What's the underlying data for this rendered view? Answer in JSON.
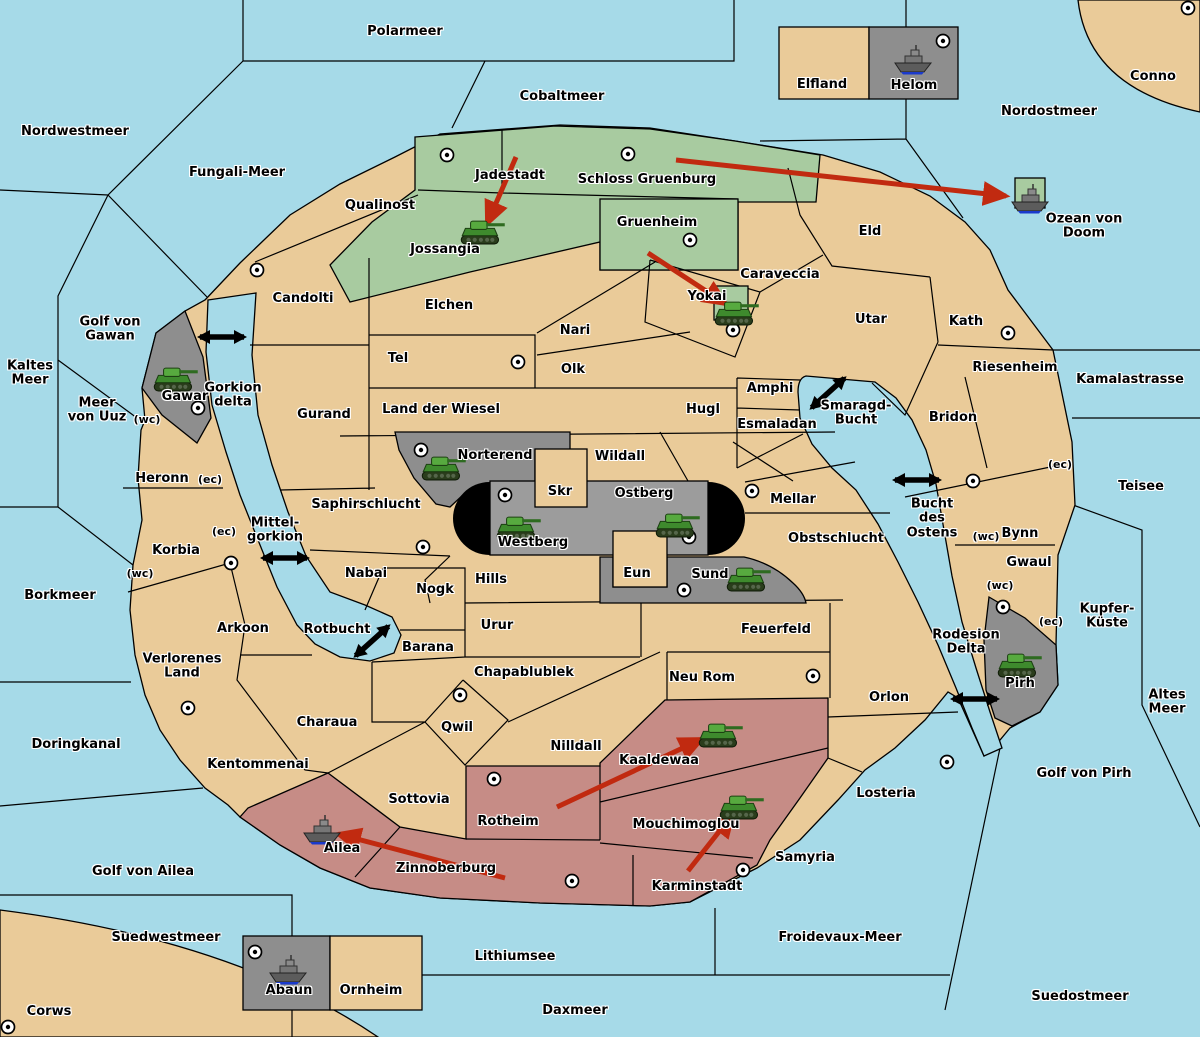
{
  "colors": {
    "sea": "#A6DAE8",
    "land": "#EACB99",
    "neutral_green": "#A8CBA0",
    "red_power": "#C68C86",
    "gray_power": "#8E8E8E",
    "band_gray": "#9C9C9C",
    "move_arrow": "#C12A10",
    "link_arrow": "#000000",
    "border": "#000000"
  },
  "labels": [
    {
      "text": "Polarmeer",
      "x": 405,
      "y": 32,
      "type": "sea"
    },
    {
      "text": "Cobaltmeer",
      "x": 562,
      "y": 97,
      "type": "sea"
    },
    {
      "text": "Nordostmeer",
      "x": 1049,
      "y": 112,
      "type": "sea"
    },
    {
      "text": "Conno",
      "x": 1153,
      "y": 77,
      "type": "land"
    },
    {
      "text": "Nordwestmeer",
      "x": 75,
      "y": 132,
      "type": "sea"
    },
    {
      "text": "Fungali-Meer",
      "x": 237,
      "y": 173,
      "type": "sea"
    },
    {
      "text": "Ozean von Doom",
      "x": 1084,
      "y": 227,
      "type": "sea"
    },
    {
      "text": "Elfland",
      "x": 822,
      "y": 85,
      "type": "land"
    },
    {
      "text": "Helom",
      "x": 914,
      "y": 86,
      "type": "land"
    },
    {
      "text": "Qualinost",
      "x": 380,
      "y": 206,
      "type": "land"
    },
    {
      "text": "Jadestadt",
      "x": 510,
      "y": 176,
      "type": "land"
    },
    {
      "text": "Schloss Gruenburg",
      "x": 647,
      "y": 180,
      "type": "land"
    },
    {
      "text": "Gruenheim",
      "x": 657,
      "y": 223,
      "type": "land"
    },
    {
      "text": "Jossangia",
      "x": 445,
      "y": 250,
      "type": "land"
    },
    {
      "text": "Eld",
      "x": 870,
      "y": 232,
      "type": "land"
    },
    {
      "text": "Candolti",
      "x": 303,
      "y": 299,
      "type": "land"
    },
    {
      "text": "Caraveccia",
      "x": 780,
      "y": 275,
      "type": "land"
    },
    {
      "text": "Yokai",
      "x": 707,
      "y": 297,
      "type": "land"
    },
    {
      "text": "Utar",
      "x": 871,
      "y": 320,
      "type": "land"
    },
    {
      "text": "Kath",
      "x": 966,
      "y": 322,
      "type": "land"
    },
    {
      "text": "Elchen",
      "x": 449,
      "y": 306,
      "type": "land"
    },
    {
      "text": "Nari",
      "x": 575,
      "y": 331,
      "type": "land"
    },
    {
      "text": "Tel",
      "x": 398,
      "y": 359,
      "type": "land"
    },
    {
      "text": "Olk",
      "x": 573,
      "y": 370,
      "type": "land"
    },
    {
      "text": "Riesenheim",
      "x": 1015,
      "y": 368,
      "type": "land"
    },
    {
      "text": "Golf von\nGawan",
      "x": 110,
      "y": 330,
      "type": "sea"
    },
    {
      "text": "Kaltes\nMeer",
      "x": 30,
      "y": 374,
      "type": "sea"
    },
    {
      "text": "Meer\nvon Uuz",
      "x": 97,
      "y": 411,
      "type": "sea"
    },
    {
      "text": "Gawar",
      "x": 185,
      "y": 397,
      "type": "land"
    },
    {
      "text": "Gorkion\ndelta",
      "x": 233,
      "y": 396,
      "type": "sea"
    },
    {
      "text": "Gurand",
      "x": 324,
      "y": 415,
      "type": "land"
    },
    {
      "text": "Land der Wiesel",
      "x": 441,
      "y": 410,
      "type": "land"
    },
    {
      "text": "Hugl",
      "x": 703,
      "y": 410,
      "type": "land"
    },
    {
      "text": "Amphi",
      "x": 770,
      "y": 389,
      "type": "land"
    },
    {
      "text": "Esmaladan",
      "x": 777,
      "y": 425,
      "type": "land"
    },
    {
      "text": "Smaragd-\nBucht",
      "x": 856,
      "y": 414,
      "type": "sea"
    },
    {
      "text": "Bridon",
      "x": 953,
      "y": 418,
      "type": "land"
    },
    {
      "text": "Kamalastrasse",
      "x": 1130,
      "y": 380,
      "type": "sea"
    },
    {
      "text": "Norterend",
      "x": 495,
      "y": 456,
      "type": "land"
    },
    {
      "text": "Wildall",
      "x": 620,
      "y": 457,
      "type": "land"
    },
    {
      "text": "Skr",
      "x": 560,
      "y": 492,
      "type": "land"
    },
    {
      "text": "Ostberg",
      "x": 644,
      "y": 494,
      "type": "land"
    },
    {
      "text": "Mellar",
      "x": 793,
      "y": 500,
      "type": "land"
    },
    {
      "text": "Heronn",
      "x": 162,
      "y": 479,
      "type": "land"
    },
    {
      "text": "Saphirschlucht",
      "x": 366,
      "y": 505,
      "type": "land"
    },
    {
      "text": "Westberg",
      "x": 533,
      "y": 543,
      "type": "land"
    },
    {
      "text": "Bynn",
      "x": 1020,
      "y": 534,
      "type": "land"
    },
    {
      "text": "Obstschlucht",
      "x": 836,
      "y": 539,
      "type": "land"
    },
    {
      "text": "Bucht\ndes\nOstens",
      "x": 932,
      "y": 519,
      "type": "sea"
    },
    {
      "text": "Teisee",
      "x": 1141,
      "y": 487,
      "type": "sea"
    },
    {
      "text": "Mittel-\ngorkion",
      "x": 275,
      "y": 531,
      "type": "sea"
    },
    {
      "text": "Korbia",
      "x": 176,
      "y": 551,
      "type": "land"
    },
    {
      "text": "Nabai",
      "x": 366,
      "y": 574,
      "type": "land"
    },
    {
      "text": "Eun",
      "x": 637,
      "y": 574,
      "type": "land"
    },
    {
      "text": "Sund",
      "x": 710,
      "y": 575,
      "type": "land"
    },
    {
      "text": "Hills",
      "x": 491,
      "y": 580,
      "type": "land"
    },
    {
      "text": "Gwaul",
      "x": 1029,
      "y": 563,
      "type": "land"
    },
    {
      "text": "Borkmeer",
      "x": 60,
      "y": 596,
      "type": "sea"
    },
    {
      "text": "Nogk",
      "x": 435,
      "y": 590,
      "type": "land"
    },
    {
      "text": "Urur",
      "x": 497,
      "y": 626,
      "type": "land"
    },
    {
      "text": "Feuerfeld",
      "x": 776,
      "y": 630,
      "type": "land"
    },
    {
      "text": "Kupfer-\nKüste",
      "x": 1107,
      "y": 617,
      "type": "sea"
    },
    {
      "text": "Rotbucht",
      "x": 337,
      "y": 630,
      "type": "sea"
    },
    {
      "text": "Barana",
      "x": 428,
      "y": 648,
      "type": "land"
    },
    {
      "text": "Arkoon",
      "x": 243,
      "y": 629,
      "type": "land"
    },
    {
      "text": "Verlorenes\nLand",
      "x": 182,
      "y": 667,
      "type": "land"
    },
    {
      "text": "Rodesion\nDelta",
      "x": 966,
      "y": 643,
      "type": "sea"
    },
    {
      "text": "Pirh",
      "x": 1020,
      "y": 684,
      "type": "land"
    },
    {
      "text": "Chapablublek",
      "x": 524,
      "y": 673,
      "type": "land"
    },
    {
      "text": "Neu Rom",
      "x": 702,
      "y": 678,
      "type": "land"
    },
    {
      "text": "Orlon",
      "x": 889,
      "y": 698,
      "type": "land"
    },
    {
      "text": "Altes\nMeer",
      "x": 1167,
      "y": 703,
      "type": "sea"
    },
    {
      "text": "Charaua",
      "x": 327,
      "y": 723,
      "type": "land"
    },
    {
      "text": "Qwil",
      "x": 457,
      "y": 728,
      "type": "land"
    },
    {
      "text": "Nilldall",
      "x": 576,
      "y": 747,
      "type": "land"
    },
    {
      "text": "Kaaldewaa",
      "x": 659,
      "y": 761,
      "type": "land"
    },
    {
      "text": "Kentommenai",
      "x": 258,
      "y": 765,
      "type": "land"
    },
    {
      "text": "Doringkanal",
      "x": 76,
      "y": 745,
      "type": "sea"
    },
    {
      "text": "Losteria",
      "x": 886,
      "y": 794,
      "type": "land"
    },
    {
      "text": "Sottovia",
      "x": 419,
      "y": 800,
      "type": "land"
    },
    {
      "text": "Golf von Pirh",
      "x": 1084,
      "y": 774,
      "type": "sea"
    },
    {
      "text": "Rotheim",
      "x": 508,
      "y": 822,
      "type": "land"
    },
    {
      "text": "Mouchimoglou",
      "x": 686,
      "y": 825,
      "type": "land"
    },
    {
      "text": "Ailea",
      "x": 342,
      "y": 849,
      "type": "land"
    },
    {
      "text": "Samyria",
      "x": 805,
      "y": 858,
      "type": "land"
    },
    {
      "text": "Zinnoberburg",
      "x": 446,
      "y": 869,
      "type": "land"
    },
    {
      "text": "Karminstadt",
      "x": 697,
      "y": 887,
      "type": "land"
    },
    {
      "text": "Golf von Ailea",
      "x": 143,
      "y": 872,
      "type": "sea"
    },
    {
      "text": "Suedwestmeer",
      "x": 166,
      "y": 938,
      "type": "sea"
    },
    {
      "text": "Froidevaux-Meer",
      "x": 840,
      "y": 938,
      "type": "sea"
    },
    {
      "text": "Lithiumsee",
      "x": 515,
      "y": 957,
      "type": "sea"
    },
    {
      "text": "Abaun",
      "x": 289,
      "y": 991,
      "type": "land"
    },
    {
      "text": "Ornheim",
      "x": 371,
      "y": 991,
      "type": "land"
    },
    {
      "text": "Suedostmeer",
      "x": 1080,
      "y": 997,
      "type": "sea"
    },
    {
      "text": "Daxmeer",
      "x": 575,
      "y": 1011,
      "type": "sea"
    },
    {
      "text": "Corws",
      "x": 49,
      "y": 1012,
      "type": "land"
    }
  ],
  "coast_labels": [
    {
      "text": "(wc)",
      "x": 147,
      "y": 420
    },
    {
      "text": "(ec)",
      "x": 210,
      "y": 480
    },
    {
      "text": "(ec)",
      "x": 224,
      "y": 532
    },
    {
      "text": "(wc)",
      "x": 140,
      "y": 574
    },
    {
      "text": "(ec)",
      "x": 1060,
      "y": 465
    },
    {
      "text": "(wc)",
      "x": 986,
      "y": 537
    },
    {
      "text": "(wc)",
      "x": 1000,
      "y": 586
    },
    {
      "text": "(ec)",
      "x": 1051,
      "y": 622
    }
  ],
  "supply_centers": [
    {
      "x": 447,
      "y": 155
    },
    {
      "x": 628,
      "y": 154
    },
    {
      "x": 943,
      "y": 41
    },
    {
      "x": 1188,
      "y": 8
    },
    {
      "x": 690,
      "y": 240
    },
    {
      "x": 257,
      "y": 270
    },
    {
      "x": 733,
      "y": 330
    },
    {
      "x": 518,
      "y": 362
    },
    {
      "x": 1008,
      "y": 333
    },
    {
      "x": 198,
      "y": 408
    },
    {
      "x": 421,
      "y": 450
    },
    {
      "x": 505,
      "y": 495
    },
    {
      "x": 689,
      "y": 537
    },
    {
      "x": 752,
      "y": 491
    },
    {
      "x": 684,
      "y": 590
    },
    {
      "x": 231,
      "y": 563
    },
    {
      "x": 423,
      "y": 547
    },
    {
      "x": 973,
      "y": 481
    },
    {
      "x": 188,
      "y": 708
    },
    {
      "x": 460,
      "y": 695
    },
    {
      "x": 813,
      "y": 676
    },
    {
      "x": 947,
      "y": 762
    },
    {
      "x": 494,
      "y": 779
    },
    {
      "x": 572,
      "y": 881
    },
    {
      "x": 743,
      "y": 870
    },
    {
      "x": 1003,
      "y": 607
    },
    {
      "x": 255,
      "y": 952
    },
    {
      "x": 8,
      "y": 1027
    }
  ],
  "units": [
    {
      "type": "tank",
      "region": "Jossangia",
      "x": 483,
      "y": 231
    },
    {
      "type": "tank",
      "region": "Yokai",
      "x": 737,
      "y": 312
    },
    {
      "type": "tank",
      "region": "Gawar",
      "x": 176,
      "y": 378
    },
    {
      "type": "tank",
      "region": "Norterend",
      "x": 444,
      "y": 467
    },
    {
      "type": "tank",
      "region": "Westberg",
      "x": 519,
      "y": 527
    },
    {
      "type": "tank",
      "region": "Ostberg",
      "x": 678,
      "y": 524
    },
    {
      "type": "tank",
      "region": "Sund",
      "x": 749,
      "y": 578
    },
    {
      "type": "tank",
      "region": "Kaaldewaa",
      "x": 721,
      "y": 734
    },
    {
      "type": "tank",
      "region": "Mouchimoglou",
      "x": 742,
      "y": 806
    },
    {
      "type": "tank",
      "region": "Pirh",
      "x": 1020,
      "y": 664
    },
    {
      "type": "ship",
      "region": "Helom",
      "x": 913,
      "y": 60
    },
    {
      "type": "ship",
      "region": "Ozean von Doom",
      "x": 1030,
      "y": 199
    },
    {
      "type": "ship",
      "region": "Ailea",
      "x": 322,
      "y": 830
    },
    {
      "type": "ship",
      "region": "Abaun",
      "x": 288,
      "y": 970
    }
  ],
  "move_arrows": [
    {
      "x1": 516,
      "y1": 157,
      "x2": 487,
      "y2": 224
    },
    {
      "x1": 676,
      "y1": 160,
      "x2": 1006,
      "y2": 196
    },
    {
      "x1": 648,
      "y1": 253,
      "x2": 726,
      "y2": 304
    },
    {
      "x1": 557,
      "y1": 807,
      "x2": 702,
      "y2": 739
    },
    {
      "x1": 688,
      "y1": 871,
      "x2": 733,
      "y2": 814
    },
    {
      "x1": 505,
      "y1": 878,
      "x2": 338,
      "y2": 834
    }
  ],
  "link_arrows": [
    {
      "x": 222,
      "y": 337,
      "angle": 0
    },
    {
      "x": 285,
      "y": 558,
      "angle": 0
    },
    {
      "x": 372,
      "y": 641,
      "angle": -42
    },
    {
      "x": 828,
      "y": 393,
      "angle": -42
    },
    {
      "x": 917,
      "y": 480,
      "angle": 0
    },
    {
      "x": 975,
      "y": 699,
      "angle": 0
    }
  ]
}
